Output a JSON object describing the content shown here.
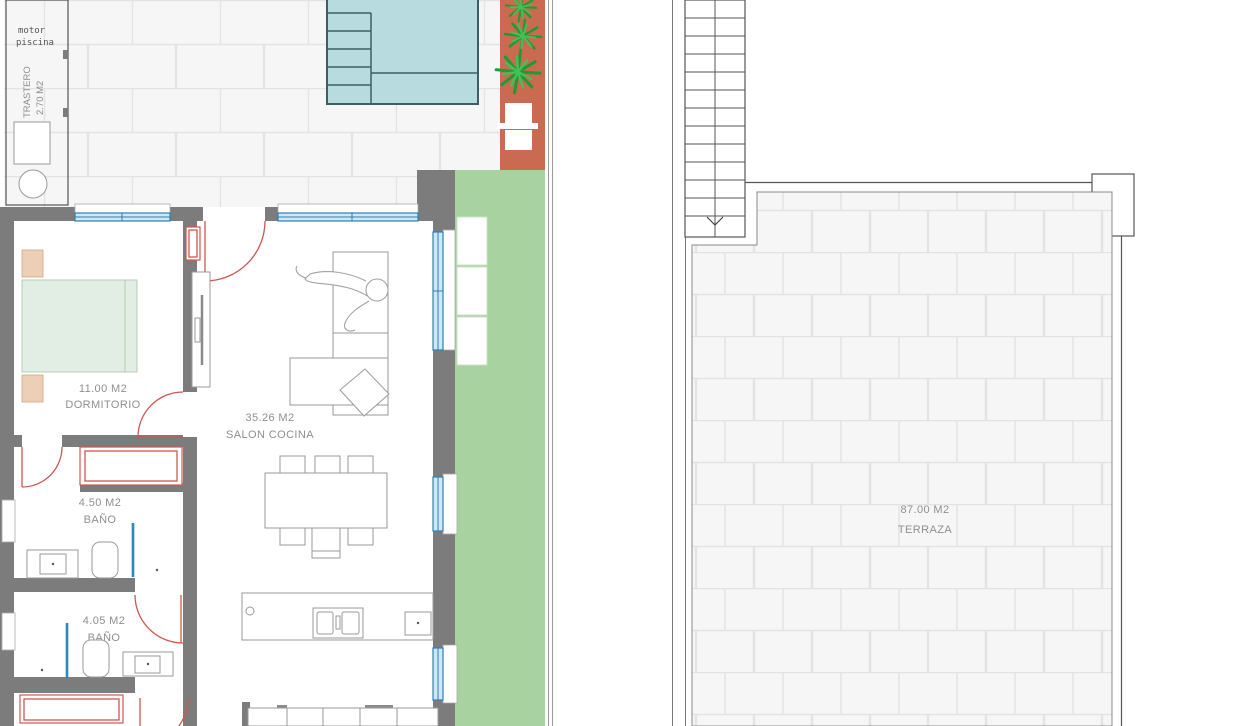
{
  "plan_title": "floor-plan",
  "rooms": {
    "trastero": {
      "label": "TRASTERO",
      "area": "2.70 M2",
      "note_line1": "motor",
      "note_line2": "piscina"
    },
    "dormitorio": {
      "area": "11.00 M2",
      "label": "DORMITORIO"
    },
    "salon_cocina": {
      "area": "35.26 M2",
      "label": "SALON COCINA"
    },
    "bano_1": {
      "area": "4.50 M2",
      "label": "BAÑO"
    },
    "bano_2": {
      "area": "4.05 M2",
      "label": "BAÑO"
    },
    "terraza": {
      "area": "87.00 M2",
      "label": "TERRAZA"
    }
  },
  "colors": {
    "wall": "#7c7c7c",
    "pool_fill": "#b7dbdf",
    "pool_border": "#3f5e64",
    "paving_red": "#c96a51",
    "grass": "#a8d2a0",
    "window_blue": "#2f7fb5",
    "window_fill": "#cfe7f6",
    "door_red": "#d0564e",
    "shower_blue": "#2e86c1",
    "plant_dark": "#1d9c33",
    "plant_light": "#43c156",
    "bed_fill": "#e2eee3",
    "bed_border": "#b7ccb9",
    "nightstand_fill": "#eccfb6",
    "nightstand_border": "#cfa985",
    "furniture_line": "#9a9a9a",
    "label_text": "#8f8f8f",
    "tile_fill": "#f6f6f6",
    "tile_line": "#e3e3e3",
    "boundary_line": "#555555"
  }
}
